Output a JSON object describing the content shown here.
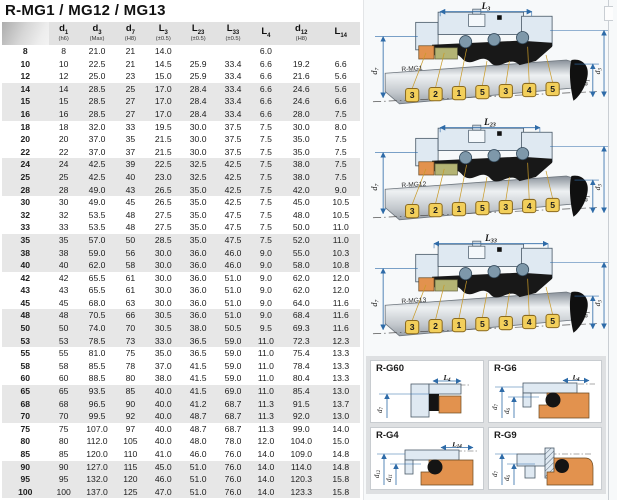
{
  "title": "R-MG1 / MG12 / MG13",
  "table": {
    "columns": [
      {
        "sym": "",
        "sub": "",
        "tol": ""
      },
      {
        "sym": "d",
        "sub": "1",
        "tol": "(h6)"
      },
      {
        "sym": "d",
        "sub": "3",
        "tol": "(Max)"
      },
      {
        "sym": "d",
        "sub": "7",
        "tol": "(H8)"
      },
      {
        "sym": "L",
        "sub": "3",
        "tol": "(±0.5)"
      },
      {
        "sym": "L",
        "sub": "23",
        "tol": "(±0.5)"
      },
      {
        "sym": "L",
        "sub": "33",
        "tol": "(±0.5)"
      },
      {
        "sym": "L",
        "sub": "4",
        "tol": ""
      },
      {
        "sym": "d",
        "sub": "12",
        "tol": "(H8)"
      },
      {
        "sym": "L",
        "sub": "14",
        "tol": ""
      }
    ],
    "rows": [
      [
        "8",
        "8",
        "21.0",
        "21",
        "14.0",
        "",
        "",
        "6.0",
        "",
        ""
      ],
      [
        "10",
        "10",
        "22.5",
        "21",
        "14.5",
        "25.9",
        "33.4",
        "6.6",
        "19.2",
        "6.6"
      ],
      [
        "12",
        "12",
        "25.0",
        "23",
        "15.0",
        "25.9",
        "33.4",
        "6.6",
        "21.6",
        "5.6"
      ],
      [
        "14",
        "14",
        "28.5",
        "25",
        "17.0",
        "28.4",
        "33.4",
        "6.6",
        "24.6",
        "5.6"
      ],
      [
        "15",
        "15",
        "28.5",
        "27",
        "17.0",
        "28.4",
        "33.4",
        "6.6",
        "24.6",
        "6.6"
      ],
      [
        "16",
        "16",
        "28.5",
        "27",
        "17.0",
        "28.4",
        "33.4",
        "6.6",
        "28.0",
        "7.5"
      ],
      [
        "18",
        "18",
        "32.0",
        "33",
        "19.5",
        "30.0",
        "37.5",
        "7.5",
        "30.0",
        "8.0"
      ],
      [
        "20",
        "20",
        "37.0",
        "35",
        "21.5",
        "30.0",
        "37.5",
        "7.5",
        "35.0",
        "7.5"
      ],
      [
        "22",
        "22",
        "37.0",
        "37",
        "21.5",
        "30.0",
        "37.5",
        "7.5",
        "35.0",
        "7.5"
      ],
      [
        "24",
        "24",
        "42.5",
        "39",
        "22.5",
        "32.5",
        "42.5",
        "7.5",
        "38.0",
        "7.5"
      ],
      [
        "25",
        "25",
        "42.5",
        "40",
        "23.0",
        "32.5",
        "42.5",
        "7.5",
        "38.0",
        "7.5"
      ],
      [
        "28",
        "28",
        "49.0",
        "43",
        "26.5",
        "35.0",
        "42.5",
        "7.5",
        "42.0",
        "9.0"
      ],
      [
        "30",
        "30",
        "49.0",
        "45",
        "26.5",
        "35.0",
        "42.5",
        "7.5",
        "45.0",
        "10.5"
      ],
      [
        "32",
        "32",
        "53.5",
        "48",
        "27.5",
        "35.0",
        "47.5",
        "7.5",
        "48.0",
        "10.5"
      ],
      [
        "33",
        "33",
        "53.5",
        "48",
        "27.5",
        "35.0",
        "47.5",
        "7.5",
        "50.0",
        "11.0"
      ],
      [
        "35",
        "35",
        "57.0",
        "50",
        "28.5",
        "35.0",
        "47.5",
        "7.5",
        "52.0",
        "11.0"
      ],
      [
        "38",
        "38",
        "59.0",
        "56",
        "30.0",
        "36.0",
        "46.0",
        "9.0",
        "55.0",
        "10.3"
      ],
      [
        "40",
        "40",
        "62.0",
        "58",
        "30.0",
        "36.0",
        "46.0",
        "9.0",
        "58.0",
        "10.8"
      ],
      [
        "42",
        "42",
        "65.5",
        "61",
        "30.0",
        "36.0",
        "51.0",
        "9.0",
        "62.0",
        "12.0"
      ],
      [
        "43",
        "43",
        "65.5",
        "61",
        "30.0",
        "36.0",
        "51.0",
        "9.0",
        "62.0",
        "12.0"
      ],
      [
        "45",
        "45",
        "68.0",
        "63",
        "30.0",
        "36.0",
        "51.0",
        "9.0",
        "64.0",
        "11.6"
      ],
      [
        "48",
        "48",
        "70.5",
        "66",
        "30.5",
        "36.0",
        "51.0",
        "9.0",
        "68.4",
        "11.6"
      ],
      [
        "50",
        "50",
        "74.0",
        "70",
        "30.5",
        "38.0",
        "50.5",
        "9.5",
        "69.3",
        "11.6"
      ],
      [
        "53",
        "53",
        "78.5",
        "73",
        "33.0",
        "36.5",
        "59.0",
        "11.0",
        "72.3",
        "12.3"
      ],
      [
        "55",
        "55",
        "81.0",
        "75",
        "35.0",
        "36.5",
        "59.0",
        "11.0",
        "75.4",
        "13.3"
      ],
      [
        "58",
        "58",
        "85.5",
        "78",
        "37.0",
        "41.5",
        "59.0",
        "11.0",
        "78.4",
        "13.3"
      ],
      [
        "60",
        "60",
        "88.5",
        "80",
        "38.0",
        "41.5",
        "59.0",
        "11.0",
        "80.4",
        "13.3"
      ],
      [
        "65",
        "65",
        "93.5",
        "85",
        "40.0",
        "41.5",
        "69.0",
        "11.0",
        "85.4",
        "13.0"
      ],
      [
        "68",
        "68",
        "96.5",
        "90",
        "40.0",
        "41.2",
        "68.7",
        "11.3",
        "91.5",
        "13.7"
      ],
      [
        "70",
        "70",
        "99.5",
        "92",
        "40.0",
        "48.7",
        "68.7",
        "11.3",
        "92.0",
        "13.0"
      ],
      [
        "75",
        "75",
        "107.0",
        "97",
        "40.0",
        "48.7",
        "68.7",
        "11.3",
        "99.0",
        "14.0"
      ],
      [
        "80",
        "80",
        "112.0",
        "105",
        "40.0",
        "48.0",
        "78.0",
        "12.0",
        "104.0",
        "15.0"
      ],
      [
        "85",
        "85",
        "120.0",
        "110",
        "41.0",
        "46.0",
        "76.0",
        "14.0",
        "109.0",
        "14.8"
      ],
      [
        "90",
        "90",
        "127.0",
        "115",
        "45.0",
        "51.0",
        "76.0",
        "14.0",
        "114.0",
        "14.8"
      ],
      [
        "95",
        "95",
        "132.0",
        "120",
        "46.0",
        "51.0",
        "76.0",
        "14.0",
        "120.3",
        "15.8"
      ],
      [
        "100",
        "100",
        "137.0",
        "125",
        "47.0",
        "51.0",
        "76.0",
        "14.0",
        "123.3",
        "15.8"
      ]
    ]
  },
  "diagrams": [
    {
      "id": "R-MG1",
      "dim": {
        "sym": "L",
        "sub": "3"
      },
      "left": {
        "sym": "d",
        "sub": "7"
      },
      "right": [
        {
          "sym": "d",
          "sub": "1"
        },
        {
          "sym": "d",
          "sub": "3"
        }
      ],
      "callouts": [
        "3",
        "2",
        "1",
        "5",
        "3",
        "4",
        "5"
      ]
    },
    {
      "id": "R-MG12",
      "dim": {
        "sym": "L",
        "sub": "23"
      },
      "left": {
        "sym": "d",
        "sub": "7"
      },
      "right": [
        {
          "sym": "d",
          "sub": "1"
        },
        {
          "sym": "d",
          "sub": "3"
        }
      ],
      "callouts": [
        "3",
        "2",
        "1",
        "5",
        "3",
        "4",
        "5"
      ]
    },
    {
      "id": "R-MG13",
      "dim": {
        "sym": "L",
        "sub": "33"
      },
      "left": {
        "sym": "d",
        "sub": "7"
      },
      "right": [
        {
          "sym": "d",
          "sub": "1"
        },
        {
          "sym": "d",
          "sub": "3"
        }
      ],
      "callouts": [
        "3",
        "2",
        "1",
        "5",
        "3",
        "4",
        "5"
      ]
    }
  ],
  "panels": [
    {
      "id": "R-G60",
      "dim": {
        "sym": "L",
        "sub": "4"
      },
      "left_dims": [
        {
          "sym": "d",
          "sub": "7"
        }
      ]
    },
    {
      "id": "R-G6",
      "dim": {
        "sym": "L",
        "sub": "4"
      },
      "left_dims": [
        {
          "sym": "d",
          "sub": "7"
        },
        {
          "sym": "d",
          "sub": "6"
        }
      ]
    },
    {
      "id": "R-G4",
      "dim": {
        "sym": "L",
        "sub": "14"
      },
      "left_dims": [
        {
          "sym": "d",
          "sub": "12"
        },
        {
          "sym": "d",
          "sub": "11"
        }
      ]
    },
    {
      "id": "R-G9",
      "left_dims": [
        {
          "sym": "d",
          "sub": "7"
        },
        {
          "sym": "d",
          "sub": "6"
        }
      ]
    }
  ],
  "colors": {
    "dimension_blue": "#2e6ba8",
    "housing_blue": "#dfe9f2",
    "seat_orange": "#e2924e",
    "carbon_olive": "#b4b474",
    "callout_yellow": "#f2cf5b",
    "stripe_gray": "#e7e7e7",
    "header_gray": "#e2e2e2"
  }
}
